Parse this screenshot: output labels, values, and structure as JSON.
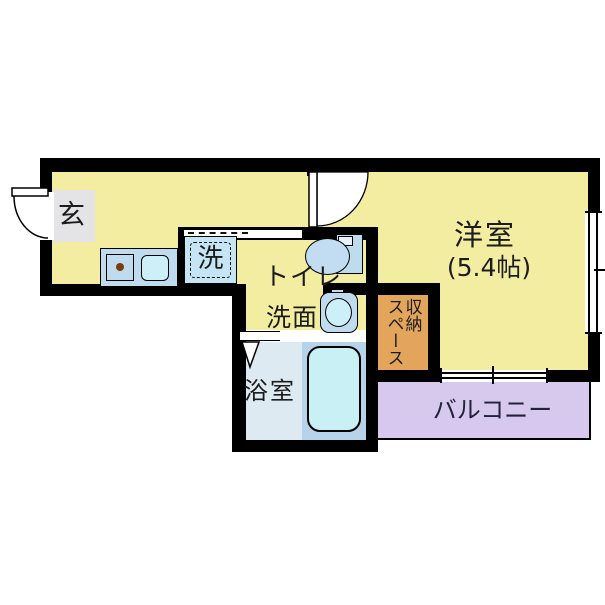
{
  "plan": {
    "labels": {
      "entrance": "玄",
      "washer": "洗",
      "toilet": "トイレ",
      "washbasin": "洗面",
      "western_room": "洋室",
      "western_room_size": "(5.4帖)",
      "storage_col_right": "収納",
      "storage_col_left": "スペース",
      "bathroom": "浴室",
      "balcony": "バルコニー"
    },
    "colors": {
      "room_yellow": "#F3EDA2",
      "entry_tile_gray": "#E4E4E6",
      "counter_blue": "#BFDCEF",
      "sink_cyan": "#CDEFF7",
      "washer_blue": "#C5E4F4",
      "toilet_blue": "#C2DDF2",
      "storage_orange": "#E3A55B",
      "balcony_lavender": "#D6C9ED",
      "bath_floor_blue": "#DEEAF2",
      "bathtub_zone_blue": "#B7D3E9",
      "bathtub_cyan": "#C9F0F4",
      "stove_dot_brown": "#7A3B10",
      "wall": "#000000"
    }
  }
}
